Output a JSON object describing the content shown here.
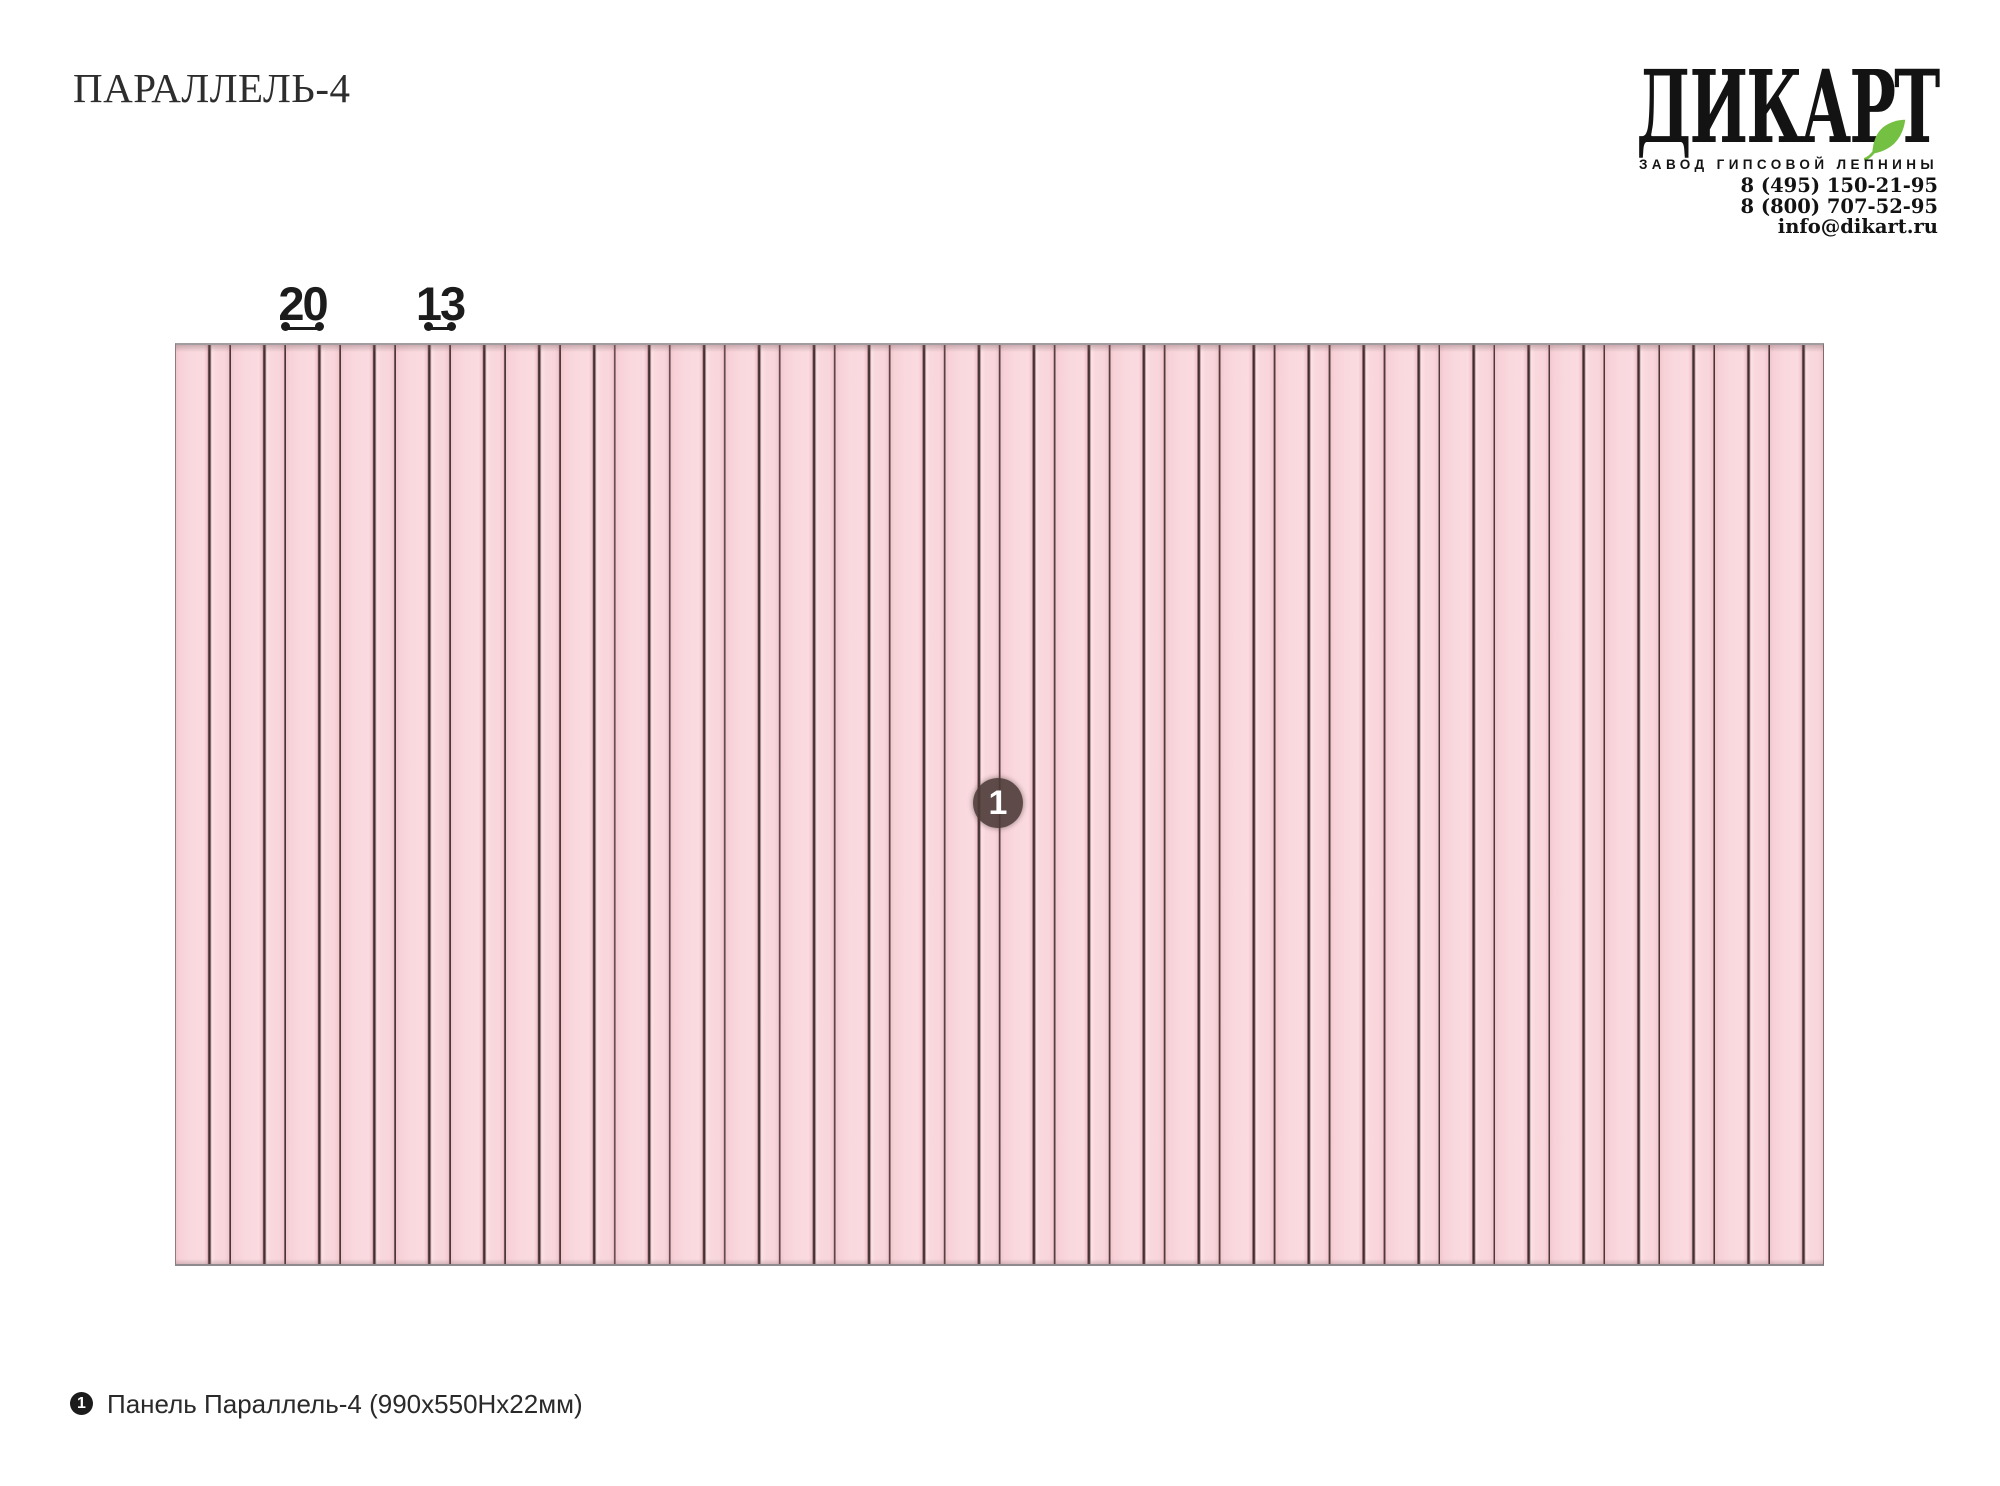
{
  "page": {
    "title": "ПАРАЛЛЕЛЬ-4"
  },
  "brand": {
    "logo": "ДИКАРТ",
    "tagline": "ЗАВОД ГИПСОВОЙ ЛЕПНИНЫ",
    "phones": [
      "8 (495) 150-21-95",
      "8 (800) 707-52-95"
    ],
    "email": "info@dikart.ru",
    "leaf_color": "#74c043",
    "text_color": "#141414"
  },
  "drawing": {
    "dim_wide_label": "20",
    "dim_narrow_label": "13",
    "badge_label": "1",
    "panel_pink": "#f8d6dc",
    "panel_pink_light": "#fbdfe4",
    "panel_pink_dark": "#f0c5cc",
    "groove_color": "#3e2d2e",
    "border_color": "#a29ba0",
    "badge_color": "#4c3b37"
  },
  "legend": {
    "marker": "1",
    "label": "Панель Параллель-4 (990х550Нх22мм)"
  }
}
